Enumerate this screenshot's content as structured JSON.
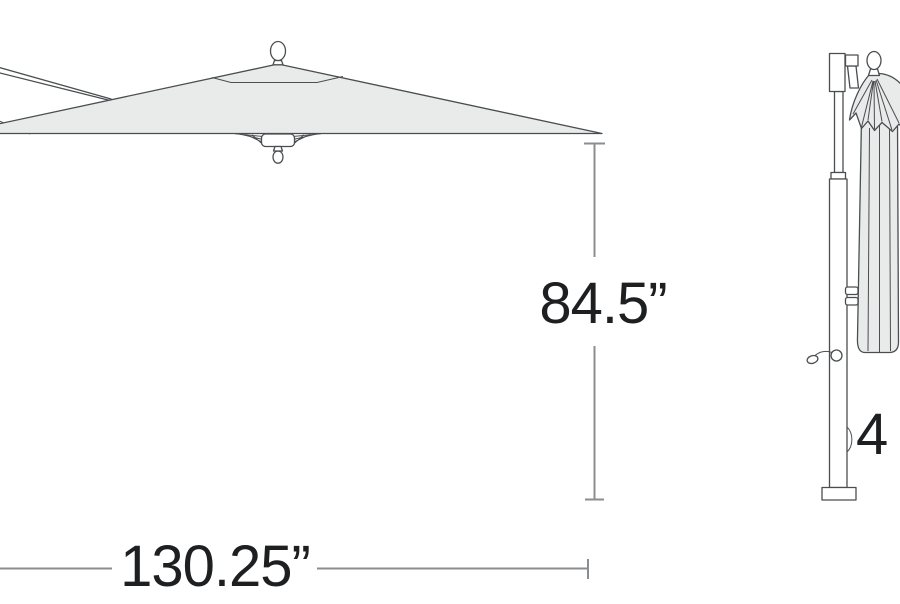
{
  "page": {
    "description": "Product dimension diagram of a cantilever patio umbrella, shown open (left) and folded closed on its pole (right)",
    "background": "#ffffff"
  },
  "colors": {
    "outline": "#4a4e50",
    "canopy_fill": "#e9ebeb",
    "dimension_line": "#8b8e90",
    "label_text": "#1d1f20"
  },
  "dimensions": {
    "height_label": "84.5”",
    "width_label": "130.25”",
    "partial_label": "4"
  },
  "illustrations": {
    "open_umbrella": "open cantilever umbrella canopy, side view, with top finial, wind vent, support arm and under-hub finial",
    "closed_umbrella": "closed umbrella folded on pole with crank handle and base plate"
  }
}
